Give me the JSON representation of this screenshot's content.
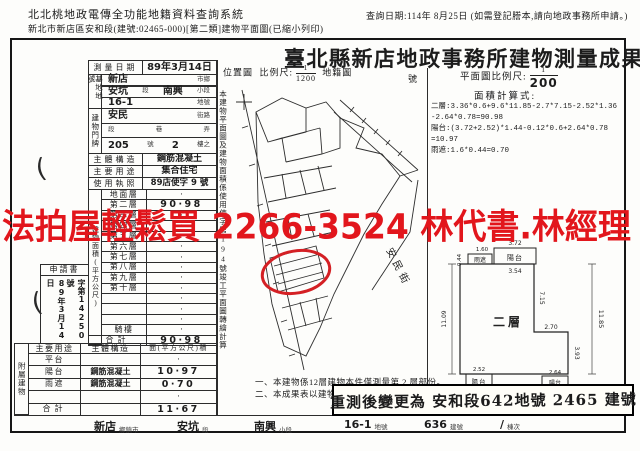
{
  "header": {
    "system_title": "北北桃地政電傳全功能地籍資料查詢系統",
    "subtitle": "新北市新店區安和段(建號:02465-000)[第二類]建物平面圖(已縮小列印)",
    "query_date": "查詢日期:114年 8月25日 (如需登記謄本,請向地政事務所申請。)"
  },
  "title": "臺北縣新店地政事務所建物測量成果圖",
  "watermark": "法拍屋輕鬆買 2266-3524 林代書.林經理",
  "colors": {
    "red": "#e2161c",
    "ink": "#1c1c1c"
  },
  "survey": {
    "date_label": "測量日期",
    "date_value": "89年3月14日",
    "site_label": "基地地號",
    "site_r1_v": "新店",
    "site_r1_s": "市鄉",
    "site_r2_v1": "安坑",
    "site_r2_s1": "段",
    "site_r2_v2": "南興",
    "site_r2_s2": "小段",
    "site_r3_v": "16-1",
    "site_r3_s": "地號",
    "door_label": "建物門牌",
    "door_r1_v": "安民",
    "door_r1_s": "街路",
    "door_r2_s1": "段",
    "door_r2_s2": "巷",
    "door_r2_s3": "弄",
    "door_r3_no": "205",
    "door_r3_s1": "號",
    "door_r3_fl": "2",
    "door_r3_s2": "樓之",
    "structure_label": "主體構造",
    "structure_value": "鋼筋混凝土",
    "usage_label": "主要用途",
    "usage_value": "集合住宅",
    "license_label": "使用執照",
    "license_value": "89店使字 9 號"
  },
  "floor_area": {
    "vertical_label": "建物面積(平方公尺)",
    "rows": [
      {
        "label": "地面層",
        "value": "·"
      },
      {
        "label": "第二層",
        "value": "90·98"
      },
      {
        "label": "第三層",
        "value": "·"
      },
      {
        "label": "第四層",
        "value": "·"
      },
      {
        "label": "第五層",
        "value": "·"
      },
      {
        "label": "第六層",
        "value": "·"
      },
      {
        "label": "第七層",
        "value": "·"
      },
      {
        "label": "第八層",
        "value": "·"
      },
      {
        "label": "第九層",
        "value": "·"
      },
      {
        "label": "第十層",
        "value": "·"
      },
      {
        "label": "",
        "value": "·"
      },
      {
        "label": "",
        "value": "·"
      },
      {
        "label": "",
        "value": "·"
      },
      {
        "label": "騎樓",
        "value": "·"
      },
      {
        "label": "合計",
        "value": "90·98"
      }
    ]
  },
  "application": {
    "label": "申請書",
    "date": "89年3月14日",
    "number": "字第14250號"
  },
  "annex": {
    "vertical_label": "附屬建物",
    "col_use": "主要用途",
    "col_structure": "主體構造",
    "col_area": "面(平方公尺)積",
    "rows": [
      {
        "use": "平台",
        "structure": "",
        "area": "·"
      },
      {
        "use": "陽台",
        "structure": "鋼筋混凝土",
        "area": "10·97"
      },
      {
        "use": "雨遮",
        "structure": "鋼筋混凝土",
        "area": "0·70"
      },
      {
        "use": "",
        "structure": "",
        "area": "·"
      },
      {
        "use": "合計",
        "structure": "",
        "area": "11·67"
      }
    ]
  },
  "location_map": {
    "label": "位置圖",
    "scale_label": "比例尺:",
    "scale_num": "1",
    "scale_den": "1200",
    "map_name": "地籍圖",
    "sheet_no_suffix": "號",
    "side_note": "本建物平面圖及建物面積係使用使字第194號竣工平面圖轉繪計算",
    "street": "安民街"
  },
  "plan": {
    "scale_label": "平面圖比例尺:",
    "scale_num": "1",
    "scale_den": "200",
    "calc_title": "面積計算式:",
    "calc_lines": [
      "二層:3.36*0.6+9.6*11.85-2.7*7.15-2.52*1.36",
      "-2.64*0.78=90.98",
      "陽台:(3.72+2.52)*1.44-0.12*0.6+2.64*0.78",
      "=10.97",
      "雨遮:1.6*0.44=0.70"
    ],
    "floor_label": "二層",
    "balcony_label": "陽台",
    "canopy_label": "雨遮",
    "dims": {
      "top": "3.72",
      "top_inner": "3.54",
      "canopy_w": "1.60",
      "canopy_h": "0.44",
      "right_inner": "7.15",
      "right": "11.85",
      "left": "11.09",
      "step": "2.70",
      "lower_right": "3.93",
      "bottom_left": "2.52",
      "bottom_right": "2.64",
      "bottom": "9.60"
    }
  },
  "notes": {
    "line1": "一、本建物係12層建物本件僅測量第 2 層部份。",
    "line2": "二、本成果表以建物登記謄"
  },
  "stamp": "重測後變更為 安和段642地號 2465 建號",
  "footer": {
    "pairs": [
      {
        "v": "新店",
        "s": "鄉鎮市"
      },
      {
        "v": "安坑",
        "s": "段"
      },
      {
        "v": "南興",
        "s": "小段"
      },
      {
        "v": "16-1",
        "s": "地號"
      },
      {
        "v": "636",
        "s": "建號"
      },
      {
        "v": "∕",
        "s": "棟次"
      }
    ]
  }
}
